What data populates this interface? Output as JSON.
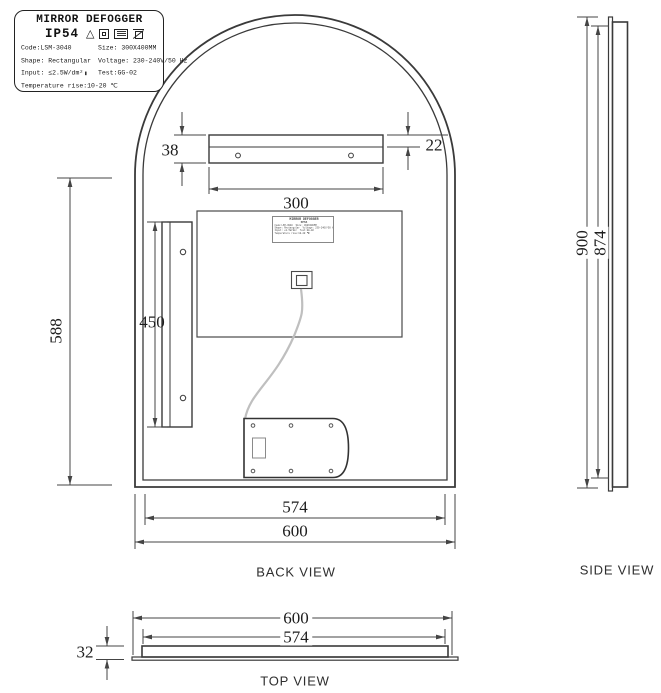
{
  "spec_label": {
    "title": "MIRROR DEFOGGER",
    "ip_rating": "IP54",
    "fields": {
      "code": "Code:LSM-3040",
      "size": "Size: 300X400MM",
      "shape": "Shape: Rectangular",
      "voltage": "Voltage: 230-240V/50 Hz",
      "input": "Input: ≤2.5W/dm²",
      "test": "Test:GG-02",
      "temperature": "Temperature rise:10-20 ℃"
    },
    "icons": [
      "warning-triangle",
      "class-ii-insulation",
      "rohs",
      "weee-bin"
    ]
  },
  "views": {
    "back": {
      "label": "BACK VIEW",
      "dimensions": {
        "outer_width": "600",
        "inner_width": "574",
        "side_height": "588",
        "bracket_width": "300",
        "bracket_height": "38",
        "bracket_lip": "22",
        "vertical_bracket_length": "450"
      }
    },
    "side": {
      "label": "SIDE VIEW",
      "dimensions": {
        "outer_height": "900",
        "inner_height": "874"
      }
    },
    "top": {
      "label": "TOP VIEW",
      "dimensions": {
        "outer_width": "600",
        "inner_width": "574",
        "thickness": "32"
      }
    }
  },
  "colors": {
    "line": "#3a3a3a",
    "dim_line": "#444444",
    "cable": "#bfbfbf",
    "background": "#ffffff"
  }
}
